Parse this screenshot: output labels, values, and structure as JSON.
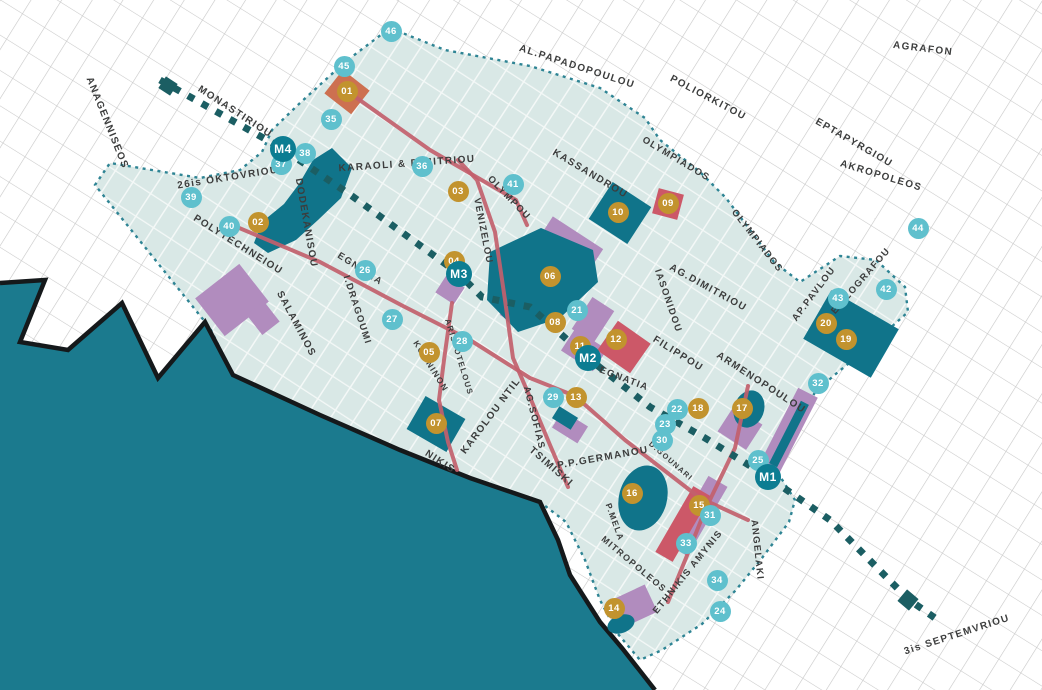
{
  "map": {
    "title": "thessaloniki-city-center-map",
    "colors": {
      "sea": "#1b7a8e",
      "coast": "#15191b",
      "district": "#d9e8e6",
      "boundary": "#2e8494",
      "teal_block": "#10748a",
      "purple": "#b18cbe",
      "red_shape": "#cc5868",
      "orange_shape": "#cd7050",
      "road": "#c2606d",
      "metro_line": "#1b5e63",
      "gold_marker": "#c2932e",
      "cyan_marker": "#5fc0cd",
      "metro_marker": "#0c7d92",
      "label_text": "#3c3d3d"
    },
    "sea_points": "0,283 45,280 20,342 68,350 122,303 158,378 205,322 233,375 320,415 400,450 470,478 540,502 558,540 570,575 600,622 622,648 655,690 0,690",
    "district_points": "390,28 445,50 530,66 600,88 645,118 660,140 700,172 726,198 756,238 774,262 800,282 840,256 876,260 905,287 908,312 868,348 838,372 815,392 802,420 788,452 776,470 795,500 789,522 762,558 736,590 702,624 662,650 640,660 618,634 600,600 585,560 566,522 540,502 470,478 400,450 320,415 233,375 210,328 95,185 110,163 152,170 200,178 240,170 262,152 272,130 300,103 345,62",
    "teal_shapes": [
      {
        "name": "old-station-building",
        "type": "poly",
        "pts": "332,148 352,168 341,198 318,220 296,240 268,253 254,243 262,222 284,204 299,184 313,160"
      },
      {
        "name": "roman-forum-block",
        "type": "poly",
        "pts": "490,252 541,228 593,250 598,282 560,318 518,332 487,300"
      },
      {
        "name": "block-10",
        "type": "rect",
        "cx": 620,
        "cy": 213,
        "w": 46,
        "h": 44,
        "rot": 33
      },
      {
        "name": "university-block",
        "type": "rect",
        "cx": 851,
        "cy": 334,
        "w": 78,
        "h": 56,
        "rot": 30
      },
      {
        "name": "rotunda",
        "type": "ellipse",
        "cx": 749,
        "cy": 409,
        "rx": 15,
        "ry": 19,
        "rot": 20
      },
      {
        "name": "aristotelous-square",
        "type": "rect",
        "cx": 436,
        "cy": 424,
        "w": 46,
        "h": 38,
        "rot": 30
      },
      {
        "name": "block-16",
        "type": "ellipse",
        "cx": 643,
        "cy": 498,
        "rx": 24,
        "ry": 33,
        "rot": 15
      },
      {
        "name": "church-13",
        "type": "rect",
        "cx": 565,
        "cy": 418,
        "w": 22,
        "h": 14,
        "rot": 32
      },
      {
        "name": "block-14",
        "type": "ellipse",
        "cx": 621,
        "cy": 624,
        "rx": 14,
        "ry": 9,
        "rot": -20
      },
      {
        "name": "strip-inner",
        "type": "rect",
        "cx": 789,
        "cy": 434,
        "w": 9,
        "h": 70,
        "rot": 27
      }
    ],
    "purple_shapes": [
      {
        "name": "ladadika-area",
        "type": "rect",
        "cx": 232,
        "cy": 300,
        "w": 56,
        "h": 48,
        "rot": -38
      },
      {
        "name": "ladadika-area-2",
        "type": "rect",
        "cx": 263,
        "cy": 318,
        "w": 22,
        "h": 26,
        "rot": -38
      },
      {
        "name": "m3-site",
        "type": "rect",
        "cx": 450,
        "cy": 290,
        "w": 22,
        "h": 20,
        "rot": 33
      },
      {
        "name": "forum-band",
        "type": "rect",
        "cx": 572,
        "cy": 242,
        "w": 60,
        "h": 22,
        "rot": 33
      },
      {
        "name": "site-21",
        "type": "rect",
        "cx": 593,
        "cy": 320,
        "w": 26,
        "h": 38,
        "rot": 33
      },
      {
        "name": "m2-site",
        "type": "rect",
        "cx": 584,
        "cy": 350,
        "w": 38,
        "h": 26,
        "rot": 33
      },
      {
        "name": "site-13",
        "type": "rect",
        "cx": 570,
        "cy": 427,
        "w": 30,
        "h": 20,
        "rot": 32
      },
      {
        "name": "site-28",
        "type": "rect",
        "cx": 510,
        "cy": 312,
        "w": 14,
        "h": 16,
        "rot": 33
      },
      {
        "name": "navarinou-purple",
        "type": "rect",
        "cx": 698,
        "cy": 516,
        "w": 22,
        "h": 80,
        "rot": 30
      },
      {
        "name": "kamara-site",
        "type": "rect",
        "cx": 740,
        "cy": 428,
        "w": 34,
        "h": 30,
        "rot": 33
      },
      {
        "name": "east-strip",
        "type": "rect",
        "cx": 788,
        "cy": 432,
        "w": 22,
        "h": 88,
        "rot": 27
      },
      {
        "name": "site-14",
        "type": "rect",
        "cx": 632,
        "cy": 607,
        "w": 42,
        "h": 30,
        "rot": -25
      }
    ],
    "red_shapes": [
      {
        "name": "landmark-01",
        "type": "rect",
        "cx": 347,
        "cy": 92,
        "w": 34,
        "h": 30,
        "rot": 38,
        "tone": "orange"
      },
      {
        "name": "landmark-09",
        "type": "rect",
        "cx": 668,
        "cy": 204,
        "w": 26,
        "h": 26,
        "rot": 15,
        "tone": "red"
      },
      {
        "name": "landmark-12",
        "type": "rect",
        "cx": 624,
        "cy": 347,
        "w": 40,
        "h": 36,
        "rot": 35,
        "tone": "red"
      },
      {
        "name": "navarinou-red",
        "type": "rect",
        "cx": 683,
        "cy": 524,
        "w": 20,
        "h": 76,
        "rot": 30,
        "tone": "red"
      }
    ],
    "roads": [
      {
        "name": "egnatia",
        "points": "225,222 320,262 403,306 470,340 530,378 575,396 625,440 700,498 748,520"
      },
      {
        "name": "venizelou",
        "points": "458,160 477,180 495,232 505,300 513,358 532,402 550,445 568,487"
      },
      {
        "name": "aristotelous",
        "points": "452,303 444,360 439,400 448,442 457,470"
      },
      {
        "name": "olympou-link",
        "points": "347,91 430,150 516,200 527,225"
      },
      {
        "name": "d-gounari",
        "points": "748,386 735,448 706,508 686,558 668,602"
      }
    ],
    "metro": {
      "points": "160,80 283,149 352,196 440,260 459,274 482,297 530,307 588,358 650,407 705,438 768,477 830,520 908,599 935,618",
      "terminals": [
        {
          "cx": 168,
          "cy": 86,
          "w": 14,
          "h": 14,
          "rot": 33
        },
        {
          "cx": 908,
          "cy": 600,
          "w": 15,
          "h": 15,
          "rot": 40
        }
      ]
    },
    "streets": [
      {
        "text": "ANAGENNISEOS",
        "x": 107,
        "y": 123,
        "rot": 68,
        "fs": 10
      },
      {
        "text": "MONASTIRIOU",
        "x": 235,
        "y": 112,
        "rot": 33,
        "fs": 10
      },
      {
        "text": "26is OKTOVRIOU",
        "x": 228,
        "y": 178,
        "rot": -9,
        "fs": 10
      },
      {
        "text": "POLYTECHNEIOU",
        "x": 238,
        "y": 245,
        "rot": 32,
        "fs": 10
      },
      {
        "text": "DODEKANISOU",
        "x": 306,
        "y": 223,
        "rot": 80,
        "fs": 10
      },
      {
        "text": "SALAMINOS",
        "x": 296,
        "y": 324,
        "rot": 62,
        "fs": 10
      },
      {
        "text": "I.DRAGOUMI",
        "x": 357,
        "y": 310,
        "rot": 72,
        "fs": 9.5
      },
      {
        "text": "KOMNINON",
        "x": 431,
        "y": 366,
        "rot": 58,
        "fs": 8.5
      },
      {
        "text": "ARISTOTELOUS",
        "x": 459,
        "y": 357,
        "rot": 73,
        "fs": 8
      },
      {
        "text": "KAROLOU NTIL",
        "x": 491,
        "y": 416,
        "rot": -53,
        "fs": 10
      },
      {
        "text": "AG.SOFIAS",
        "x": 534,
        "y": 418,
        "rot": 76,
        "fs": 9.5
      },
      {
        "text": "TSIMISKI",
        "x": 551,
        "y": 467,
        "rot": 41,
        "fs": 10
      },
      {
        "text": "NIKIS",
        "x": 440,
        "y": 462,
        "rot": 33,
        "fs": 10
      },
      {
        "text": "P.P.GERMANOU",
        "x": 603,
        "y": 458,
        "rot": -10,
        "fs": 10
      },
      {
        "text": "KARAOLI & DIMITRIOU",
        "x": 407,
        "y": 164,
        "rot": -4,
        "fs": 10
      },
      {
        "text": "KASSANDROU",
        "x": 590,
        "y": 174,
        "rot": 31,
        "fs": 10
      },
      {
        "text": "OLYMPOU",
        "x": 509,
        "y": 198,
        "rot": 46,
        "fs": 9.5
      },
      {
        "text": "VENIZELOU",
        "x": 483,
        "y": 231,
        "rot": 79,
        "fs": 9.5
      },
      {
        "text": "EGNATIA",
        "x": 360,
        "y": 269,
        "rot": 33,
        "fs": 9.5
      },
      {
        "text": "EGNATIA",
        "x": 624,
        "y": 379,
        "rot": 21,
        "fs": 9.5
      },
      {
        "text": "FILIPPOU",
        "x": 678,
        "y": 354,
        "rot": 32,
        "fs": 10
      },
      {
        "text": "IASONIDOU",
        "x": 668,
        "y": 301,
        "rot": 71,
        "fs": 9.5
      },
      {
        "text": "AG.DIMITRIOU",
        "x": 708,
        "y": 288,
        "rot": 29,
        "fs": 10
      },
      {
        "text": "ARMENOPOULOU",
        "x": 761,
        "y": 383,
        "rot": 33,
        "fs": 10
      },
      {
        "text": "AP.PAVLOU",
        "x": 814,
        "y": 294,
        "rot": -53,
        "fs": 9.5
      },
      {
        "text": "EL.ZOGRAFOU",
        "x": 861,
        "y": 281,
        "rot": -49,
        "fs": 9.5
      },
      {
        "text": "OLYMPIADOS",
        "x": 676,
        "y": 159,
        "rot": 31,
        "fs": 9.5
      },
      {
        "text": "OLYMPIADOS",
        "x": 757,
        "y": 241,
        "rot": 52,
        "fs": 9.5
      },
      {
        "text": "AL.PAPADOPOULOU",
        "x": 577,
        "y": 67,
        "rot": 18,
        "fs": 10
      },
      {
        "text": "POLIORKITOU",
        "x": 708,
        "y": 98,
        "rot": 28,
        "fs": 10
      },
      {
        "text": "AGRAFON",
        "x": 923,
        "y": 49,
        "rot": 7,
        "fs": 10
      },
      {
        "text": "EPTAPYRGIOU",
        "x": 854,
        "y": 143,
        "rot": 30,
        "fs": 10
      },
      {
        "text": "AKROPOLEOS",
        "x": 881,
        "y": 176,
        "rot": 17,
        "fs": 10
      },
      {
        "text": "ETHNIKIS AMYNIS",
        "x": 688,
        "y": 572,
        "rot": -51,
        "fs": 9.5
      },
      {
        "text": "ANGELAKI",
        "x": 757,
        "y": 550,
        "rot": 84,
        "fs": 9.5
      },
      {
        "text": "P.MELA",
        "x": 615,
        "y": 522,
        "rot": 70,
        "fs": 8.5
      },
      {
        "text": "MITROPOLEOS",
        "x": 634,
        "y": 564,
        "rot": 40,
        "fs": 9
      },
      {
        "text": "3is SEPTEMVRIOU",
        "x": 957,
        "y": 635,
        "rot": -18,
        "fs": 10
      },
      {
        "text": "D.GOUNARI",
        "x": 671,
        "y": 461,
        "rot": 41,
        "fs": 7.5
      }
    ],
    "markers": [
      {
        "id": "01",
        "x": 347,
        "y": 91,
        "t": "gold"
      },
      {
        "id": "02",
        "x": 258,
        "y": 222,
        "t": "gold"
      },
      {
        "id": "03",
        "x": 458,
        "y": 191,
        "t": "gold"
      },
      {
        "id": "04",
        "x": 454,
        "y": 261,
        "t": "gold"
      },
      {
        "id": "05",
        "x": 429,
        "y": 352,
        "t": "gold"
      },
      {
        "id": "06",
        "x": 550,
        "y": 276,
        "t": "gold"
      },
      {
        "id": "07",
        "x": 436,
        "y": 423,
        "t": "gold"
      },
      {
        "id": "08",
        "x": 555,
        "y": 322,
        "t": "gold"
      },
      {
        "id": "09",
        "x": 668,
        "y": 203,
        "t": "gold"
      },
      {
        "id": "10",
        "x": 618,
        "y": 212,
        "t": "gold"
      },
      {
        "id": "11",
        "x": 580,
        "y": 346,
        "t": "gold"
      },
      {
        "id": "12",
        "x": 616,
        "y": 339,
        "t": "gold"
      },
      {
        "id": "13",
        "x": 576,
        "y": 397,
        "t": "gold"
      },
      {
        "id": "14",
        "x": 614,
        "y": 608,
        "t": "gold"
      },
      {
        "id": "15",
        "x": 699,
        "y": 505,
        "t": "gold"
      },
      {
        "id": "16",
        "x": 632,
        "y": 493,
        "t": "gold"
      },
      {
        "id": "17",
        "x": 742,
        "y": 408,
        "t": "gold"
      },
      {
        "id": "18",
        "x": 698,
        "y": 408,
        "t": "gold"
      },
      {
        "id": "19",
        "x": 846,
        "y": 339,
        "t": "gold"
      },
      {
        "id": "20",
        "x": 826,
        "y": 323,
        "t": "gold"
      },
      {
        "id": "21",
        "x": 577,
        "y": 310,
        "t": "cyan"
      },
      {
        "id": "22",
        "x": 677,
        "y": 409,
        "t": "cyan"
      },
      {
        "id": "23",
        "x": 665,
        "y": 424,
        "t": "cyan"
      },
      {
        "id": "24",
        "x": 720,
        "y": 611,
        "t": "cyan"
      },
      {
        "id": "25",
        "x": 758,
        "y": 460,
        "t": "cyan"
      },
      {
        "id": "26",
        "x": 365,
        "y": 270,
        "t": "cyan"
      },
      {
        "id": "27",
        "x": 392,
        "y": 319,
        "t": "cyan"
      },
      {
        "id": "28",
        "x": 462,
        "y": 341,
        "t": "cyan"
      },
      {
        "id": "29",
        "x": 553,
        "y": 397,
        "t": "cyan"
      },
      {
        "id": "30",
        "x": 662,
        "y": 440,
        "t": "cyan"
      },
      {
        "id": "31",
        "x": 710,
        "y": 515,
        "t": "cyan"
      },
      {
        "id": "32",
        "x": 818,
        "y": 383,
        "t": "cyan"
      },
      {
        "id": "33",
        "x": 686,
        "y": 543,
        "t": "cyan"
      },
      {
        "id": "34",
        "x": 717,
        "y": 580,
        "t": "cyan"
      },
      {
        "id": "35",
        "x": 331,
        "y": 119,
        "t": "cyan"
      },
      {
        "id": "36",
        "x": 422,
        "y": 166,
        "t": "cyan"
      },
      {
        "id": "37",
        "x": 281,
        "y": 164,
        "t": "cyan"
      },
      {
        "id": "38",
        "x": 305,
        "y": 153,
        "t": "cyan"
      },
      {
        "id": "39",
        "x": 191,
        "y": 197,
        "t": "cyan"
      },
      {
        "id": "40",
        "x": 229,
        "y": 226,
        "t": "cyan"
      },
      {
        "id": "41",
        "x": 513,
        "y": 184,
        "t": "cyan"
      },
      {
        "id": "42",
        "x": 886,
        "y": 289,
        "t": "cyan"
      },
      {
        "id": "43",
        "x": 838,
        "y": 298,
        "t": "cyan"
      },
      {
        "id": "44",
        "x": 918,
        "y": 228,
        "t": "cyan"
      },
      {
        "id": "45",
        "x": 344,
        "y": 66,
        "t": "cyan"
      },
      {
        "id": "46",
        "x": 391,
        "y": 31,
        "t": "cyan"
      },
      {
        "id": "M1",
        "x": 768,
        "y": 477,
        "t": "metro"
      },
      {
        "id": "M2",
        "x": 588,
        "y": 358,
        "t": "metro"
      },
      {
        "id": "M3",
        "x": 459,
        "y": 274,
        "t": "metro"
      },
      {
        "id": "M4",
        "x": 283,
        "y": 149,
        "t": "metro"
      }
    ]
  }
}
